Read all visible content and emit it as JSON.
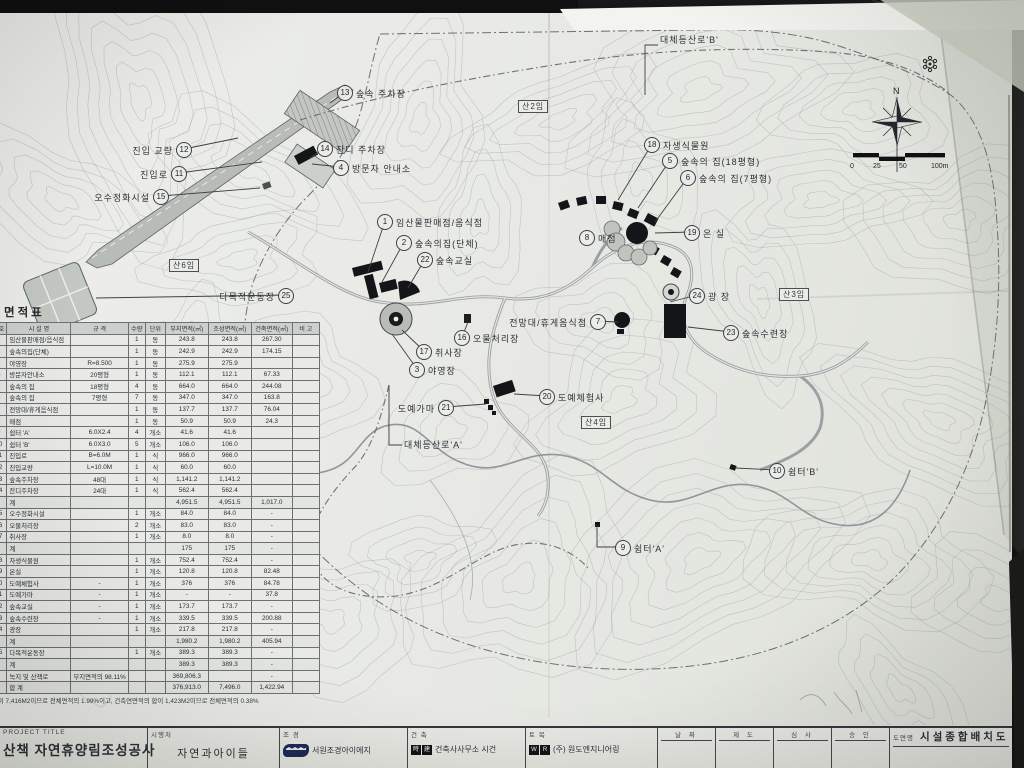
{
  "sheet": {
    "area_table": {
      "title": "면적표",
      "columns": [
        "번호",
        "시 설 명",
        "규 격",
        "수량",
        "단위",
        "부지면적(㎡)",
        "조성면적(㎡)",
        "건축면적(㎡)",
        "비 고"
      ],
      "rows": [
        {
          "c": [
            "1",
            "임산물판매점/음식점",
            "",
            "1",
            "동",
            "243.8",
            "243.8",
            "267.30",
            ""
          ]
        },
        {
          "c": [
            "2",
            "숲속의집(단체)",
            "",
            "1",
            "동",
            "242.9",
            "242.9",
            "174.15",
            ""
          ]
        },
        {
          "c": [
            "3",
            "야영장",
            "R=8.500",
            "1",
            "동",
            "275.9",
            "275.9",
            "",
            ""
          ]
        },
        {
          "c": [
            "4",
            "방문자안내소",
            "20평형",
            "1",
            "동",
            "112.1",
            "112.1",
            "67.33",
            ""
          ]
        },
        {
          "c": [
            "5",
            "숲속의 집",
            "18평형",
            "4",
            "동",
            "664.0",
            "664.0",
            "244.08",
            ""
          ]
        },
        {
          "c": [
            "6",
            "숲속의 집",
            "7평형",
            "7",
            "동",
            "347.0",
            "347.0",
            "163.8",
            ""
          ]
        },
        {
          "c": [
            "7",
            "전망대/휴게음식점",
            "",
            "1",
            "동",
            "137.7",
            "137.7",
            "76.04",
            ""
          ]
        },
        {
          "c": [
            "8",
            "매점",
            "",
            "1",
            "동",
            "50.9",
            "50.9",
            "24.3",
            ""
          ]
        },
        {
          "c": [
            "9",
            "쉼터 'A'",
            "6.0X2.4",
            "4",
            "개소",
            "41.6",
            "41.6",
            "",
            ""
          ]
        },
        {
          "c": [
            "10",
            "쉼터 'B'",
            "6.0X3.0",
            "5",
            "개소",
            "106.0",
            "106.0",
            "",
            ""
          ]
        },
        {
          "c": [
            "11",
            "진입로",
            "B=6.0M",
            "1",
            "식",
            "966.0",
            "966.0",
            "",
            ""
          ]
        },
        {
          "c": [
            "12",
            "진입교량",
            "L=10.0M",
            "1",
            "식",
            "60.0",
            "60.0",
            "",
            ""
          ]
        },
        {
          "c": [
            "13",
            "숲속주차장",
            "48대",
            "1",
            "식",
            "1,141.2",
            "1,141.2",
            "",
            ""
          ]
        },
        {
          "c": [
            "14",
            "잔디주차장",
            "24대",
            "1",
            "식",
            "562.4",
            "562.4",
            "",
            ""
          ]
        },
        {
          "c": [
            "",
            "계",
            "",
            "",
            "",
            "4,951.5",
            "4,951.5",
            "1,017.0",
            ""
          ],
          "t": 1
        },
        {
          "c": [
            "15",
            "오수정화시설",
            "",
            "1",
            "개소",
            "84.0",
            "84.0",
            "-",
            ""
          ]
        },
        {
          "c": [
            "16",
            "오물처리장",
            "",
            "2",
            "개소",
            "83.0",
            "83.0",
            "-",
            ""
          ]
        },
        {
          "c": [
            "17",
            "취사장",
            "",
            "1",
            "개소",
            "8.0",
            "8.0",
            "-",
            ""
          ]
        },
        {
          "c": [
            "",
            "계",
            "",
            "",
            "",
            "175",
            "175",
            "-",
            ""
          ],
          "t": 1
        },
        {
          "c": [
            "18",
            "자생식물원",
            "",
            "1",
            "개소",
            "752.4",
            "752.4",
            "-",
            ""
          ]
        },
        {
          "c": [
            "19",
            "온실",
            "",
            "1",
            "개소",
            "120.8",
            "120.8",
            "82.48",
            ""
          ]
        },
        {
          "c": [
            "20",
            "도예체험사",
            "-",
            "1",
            "개소",
            "376",
            "376",
            "84.78",
            ""
          ]
        },
        {
          "c": [
            "21",
            "도예가마",
            "-",
            "1",
            "개소",
            "-",
            "-",
            "37.8",
            ""
          ]
        },
        {
          "c": [
            "22",
            "숲속교실",
            "-",
            "1",
            "개소",
            "173.7",
            "173.7",
            "-",
            ""
          ]
        },
        {
          "c": [
            "23",
            "숲속수련장",
            "-",
            "1",
            "개소",
            "339.5",
            "339.5",
            "200.88",
            ""
          ]
        },
        {
          "c": [
            "24",
            "광장",
            "",
            "1",
            "개소",
            "217.8",
            "217.8",
            "-",
            ""
          ]
        },
        {
          "c": [
            "",
            "계",
            "",
            "",
            "",
            "1,980.2",
            "1,980.2",
            "405.94",
            ""
          ],
          "t": 1
        },
        {
          "c": [
            "25",
            "다목적운동장",
            "",
            "1",
            "개소",
            "389.3",
            "389.3",
            "-",
            ""
          ]
        },
        {
          "c": [
            "",
            "계",
            "",
            "",
            "",
            "389.3",
            "389.3",
            "-",
            ""
          ],
          "t": 1
        },
        {
          "c": [
            "",
            "녹지 및 산책로",
            "부지면적의 98.11%",
            "",
            "",
            "369,806.3",
            "",
            "-",
            ""
          ]
        },
        {
          "c": [
            "",
            "합 계",
            "",
            "",
            "",
            "376,913.0",
            "7,496.0",
            "1,422.94",
            ""
          ],
          "t": 1
        }
      ],
      "footnote": "합이 7,416M2이므로 전체면적의 1.99%이고, 건축연면적의 합이 1,423M2이므로 전체면적의 0.38%"
    },
    "title_block": {
      "project_label": "PROJECT TITLE",
      "project_title": "산책 자연휴양림조성공사",
      "client_label": "시행처",
      "client": "자연과아이들",
      "landscape_label": "조 경",
      "landscape": "서원조경아이에지",
      "architecture_label": "건 축",
      "architecture_logo": [
        "時",
        "建"
      ],
      "architecture": "건축사사무소 시건",
      "civil_label": "토 목",
      "civil_logo": [
        "W",
        "R"
      ],
      "civil": "(주) 원도엔지니어링",
      "sign_columns": [
        "날 짜",
        "제 도",
        "심 사",
        "승 인"
      ],
      "drawing_label": "도면명",
      "drawing_title": "시설종합배치도"
    },
    "map": {
      "compass_n": "N",
      "scale_ticks": [
        "0",
        "25",
        "50",
        "100m"
      ],
      "trail_labels": [
        {
          "text": "대체등산로'B'",
          "x": 660,
          "y": 33,
          "leader": [
            [
              658,
              45
            ],
            [
              645,
              45
            ],
            [
              645,
              95
            ]
          ]
        },
        {
          "text": "대체등산로'A'",
          "x": 404,
          "y": 438,
          "leader": [
            [
              402,
              445
            ],
            [
              389,
              445
            ],
            [
              389,
              385
            ]
          ]
        }
      ],
      "parcels": [
        {
          "label": "산2임",
          "x": 518,
          "y": 100
        },
        {
          "label": "산3임",
          "x": 779,
          "y": 288
        },
        {
          "label": "산4임",
          "x": 581,
          "y": 416
        },
        {
          "label": "산6임",
          "x": 169,
          "y": 259
        }
      ],
      "callouts": [
        {
          "num": "13",
          "label": "숲속 주차장",
          "cx": 345,
          "cy": 92,
          "side": "right",
          "leader": [
            330,
            103
          ]
        },
        {
          "num": "12",
          "label": "진입 교량",
          "cx": 184,
          "cy": 149,
          "side": "left",
          "leader": [
            238,
            138
          ]
        },
        {
          "num": "11",
          "label": "진입로",
          "cx": 179,
          "cy": 173,
          "side": "left",
          "leader": [
            262,
            162
          ]
        },
        {
          "num": "15",
          "label": "오수정화시설",
          "cx": 161,
          "cy": 196,
          "side": "left",
          "leader": [
            260,
            188
          ]
        },
        {
          "num": "14",
          "label": "잔디 주차장",
          "cx": 325,
          "cy": 148,
          "side": "right",
          "leader": [
            310,
            158
          ]
        },
        {
          "num": "4",
          "label": "방문자 안내소",
          "cx": 341,
          "cy": 167,
          "side": "right",
          "leader": [
            312,
            164
          ]
        },
        {
          "num": "1",
          "label": "임산물판매점/음식점",
          "cx": 385,
          "cy": 221,
          "side": "right",
          "leader": [
            368,
            272
          ]
        },
        {
          "num": "2",
          "label": "숲속의집(단체)",
          "cx": 404,
          "cy": 242,
          "side": "right",
          "leader": [
            382,
            282
          ]
        },
        {
          "num": "22",
          "label": "숲속교실",
          "cx": 425,
          "cy": 259,
          "side": "right",
          "leader": [
            408,
            288
          ]
        },
        {
          "num": "25",
          "label": "다목적운동장",
          "cx": 286,
          "cy": 295,
          "side": "left",
          "leader": [
            96,
            298
          ]
        },
        {
          "num": "16",
          "label": "오물처리장",
          "cx": 462,
          "cy": 337,
          "side": "right",
          "leader": [
            468,
            322
          ]
        },
        {
          "num": "17",
          "label": "취사장",
          "cx": 424,
          "cy": 351,
          "side": "right",
          "leader": [
            402,
            330
          ]
        },
        {
          "num": "3",
          "label": "야영장",
          "cx": 417,
          "cy": 369,
          "side": "right",
          "leader": [
            392,
            334
          ]
        },
        {
          "num": "18",
          "label": "자생식물원",
          "cx": 652,
          "cy": 144,
          "side": "right",
          "leader": [
            618,
            200
          ]
        },
        {
          "num": "5",
          "label": "숲속의 집(18평형)",
          "cx": 670,
          "cy": 160,
          "side": "right",
          "leader": [
            638,
            208
          ]
        },
        {
          "num": "6",
          "label": "숲속의 집(7평형)",
          "cx": 688,
          "cy": 177,
          "side": "right",
          "leader": [
            655,
            222
          ]
        },
        {
          "num": "8",
          "label": "매점",
          "cx": 587,
          "cy": 237,
          "side": "right"
        },
        {
          "num": "19",
          "label": "온 실",
          "cx": 692,
          "cy": 232,
          "side": "right",
          "leader": [
            655,
            233
          ]
        },
        {
          "num": "24",
          "label": "광 장",
          "cx": 697,
          "cy": 295,
          "side": "right",
          "leader": [
            670,
            302
          ]
        },
        {
          "num": "7",
          "label": "전망대/휴게음식점",
          "cx": 598,
          "cy": 321,
          "side": "left",
          "leader": [
            618,
            322
          ]
        },
        {
          "num": "23",
          "label": "숲속수련장",
          "cx": 731,
          "cy": 332,
          "side": "right",
          "leader": [
            688,
            327
          ]
        },
        {
          "num": "20",
          "label": "도예체험사",
          "cx": 547,
          "cy": 396,
          "side": "right",
          "leader": [
            514,
            394
          ]
        },
        {
          "num": "21",
          "label": "도예가마",
          "cx": 446,
          "cy": 407,
          "side": "left",
          "leader": [
            486,
            404
          ]
        },
        {
          "num": "9",
          "label": "쉼터'A'",
          "cx": 623,
          "cy": 547,
          "side": "right",
          "leader": [
            597,
            525
          ],
          "via": [
            597,
            547
          ]
        },
        {
          "num": "10",
          "label": "쉼터'B'",
          "cx": 777,
          "cy": 470,
          "side": "right",
          "leader": [
            735,
            468
          ]
        }
      ]
    },
    "colors": {
      "paper": "#e9eae6",
      "ink": "#2c3136",
      "building": "#141518",
      "contour": "#a4adb1"
    }
  }
}
